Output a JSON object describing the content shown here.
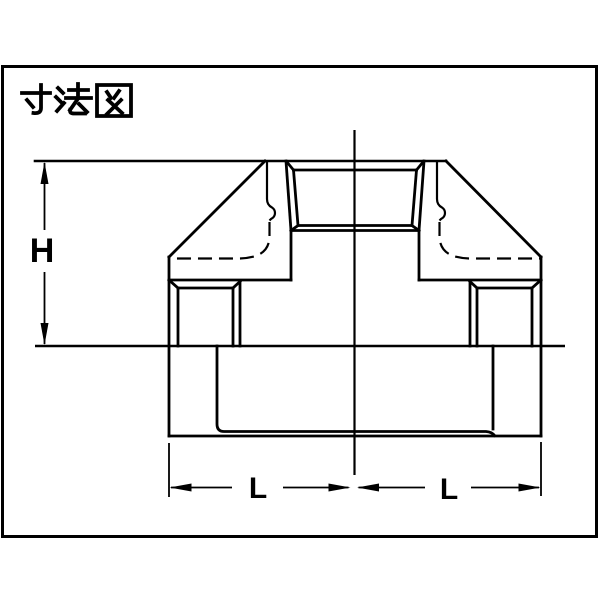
{
  "page": {
    "background_color": "#ffffff",
    "ink_color": "#000000"
  },
  "title": {
    "text": "寸法図"
  },
  "dimension_labels": {
    "height": "H",
    "length_left": "L",
    "length_right": "L"
  }
}
